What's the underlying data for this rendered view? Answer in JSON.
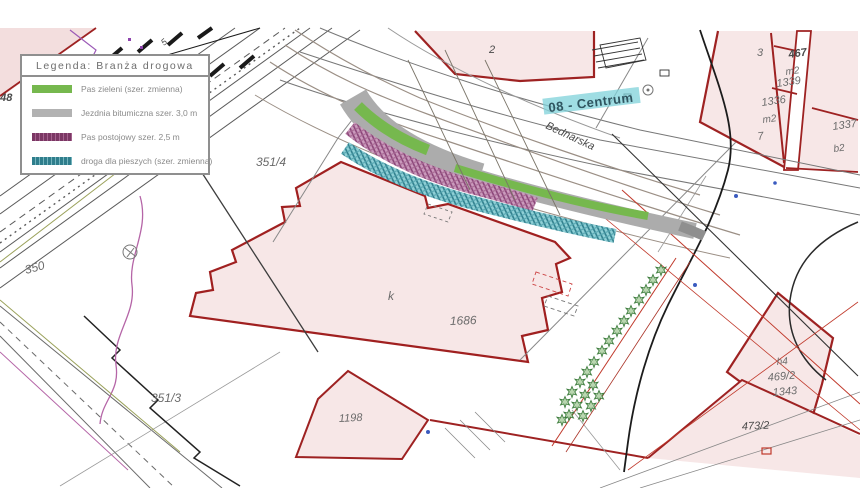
{
  "legend": {
    "title": "Legenda:  Branża drogowa",
    "items": [
      {
        "label": "Pas zieleni (szer. zmienna)",
        "color": "#76b84e",
        "swatch": "solid-green"
      },
      {
        "label": "Jezdnia bitumiczna szer. 3,0 m",
        "color": "#b2b2b2",
        "swatch": "solid-gray"
      },
      {
        "label": "Pas postojowy szer. 2,5 m",
        "color": "#7b3764",
        "swatch": "hatch-purple"
      },
      {
        "label": "droga dla pieszych (szer. zmienna)",
        "color": "#2f7e8c",
        "swatch": "hatch-teal"
      }
    ]
  },
  "map": {
    "district_label": "08 - Centrum",
    "street_label": "Bednarska",
    "labels": {
      "l348": "348",
      "l350": "350",
      "l351_4": "351/4",
      "l351_3": "351/3",
      "l2": "2",
      "l5": "5",
      "lk": "k",
      "l1686": "1686",
      "l1198": "1198",
      "l3": "3",
      "l467": "467",
      "lm2a": "m2",
      "l1339": "1339",
      "l1336": "1336",
      "lm2b": "m2",
      "l7": "7",
      "l1337": "1337",
      "lb2": "b2",
      "lh4": "h4",
      "l469_2": "469/2",
      "l1343": "1343",
      "l473_2": "473/2"
    },
    "colors": {
      "parcel_fill": "#f7e7e7",
      "parcel_border": "#9e2222",
      "green_strip": "#76b84e",
      "asphalt_gray": "#acacac",
      "parking_purple": "#7b3764",
      "pedestrian_teal": "#2f7e8c",
      "district_highlight": "#7fd2da"
    }
  }
}
